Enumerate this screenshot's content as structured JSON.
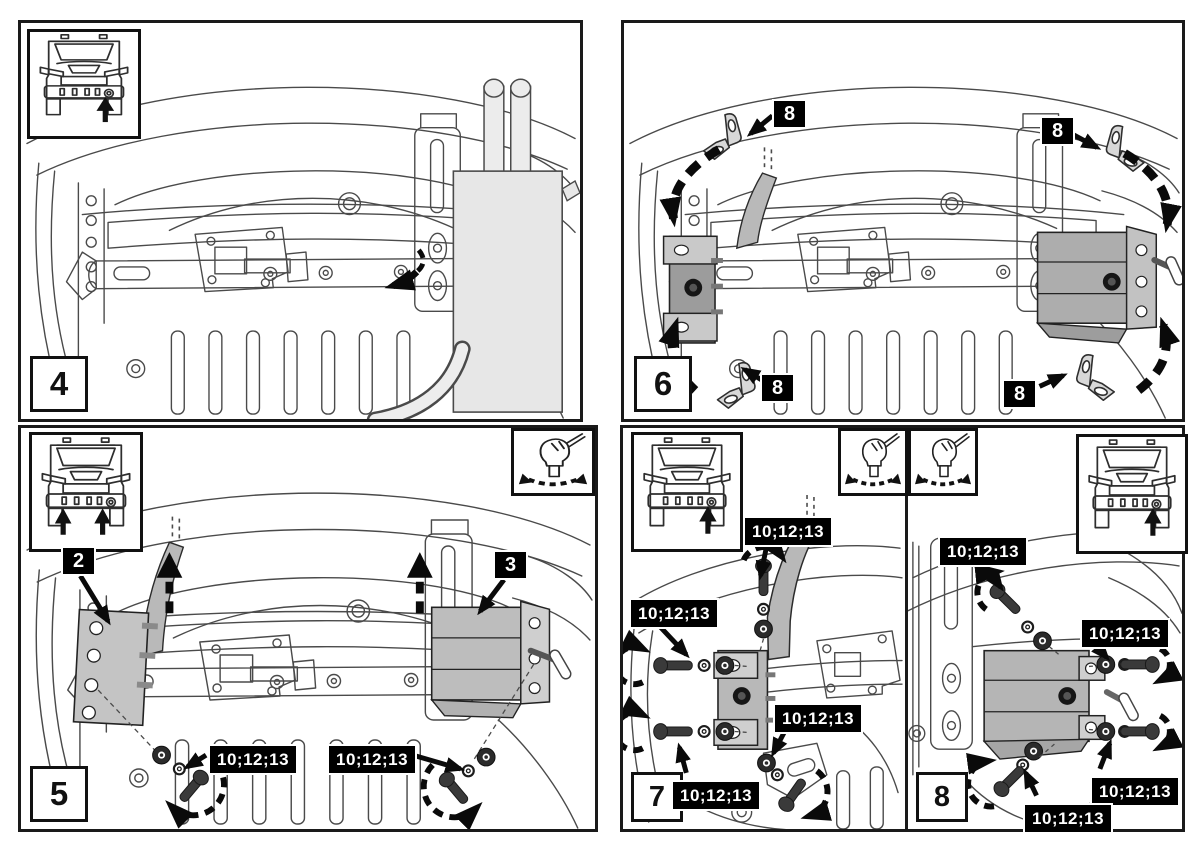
{
  "figure_type": "vehicle accessory installation instruction sheet",
  "steps": {
    "s4": "4",
    "s5": "5",
    "s6": "6",
    "s7": "7",
    "s8": "8"
  },
  "callouts": {
    "left_bracket": "2",
    "right_bracket": "3",
    "corner_bracket": "8",
    "hardware_items": "10;12;13"
  },
  "icons": {
    "car_inset": "car-front-with-arrow-icon",
    "tool_inset": "hand-turning-fastener-icon",
    "rotation": "dashed-rotation-arrow-icon",
    "lift": "dashed-up-arrow-icon"
  },
  "colors": {
    "background": "#ffffff",
    "panel_border": "#1a1a1a",
    "label_bg": "#000000",
    "label_text": "#ffffff",
    "line_art": "#4a4a4a",
    "part_fill": "#bdbdbd",
    "dark_part_fill": "#9c9c9c",
    "block_fill": "#e7e7e7",
    "hardware_dark": "#2b2b2b"
  }
}
